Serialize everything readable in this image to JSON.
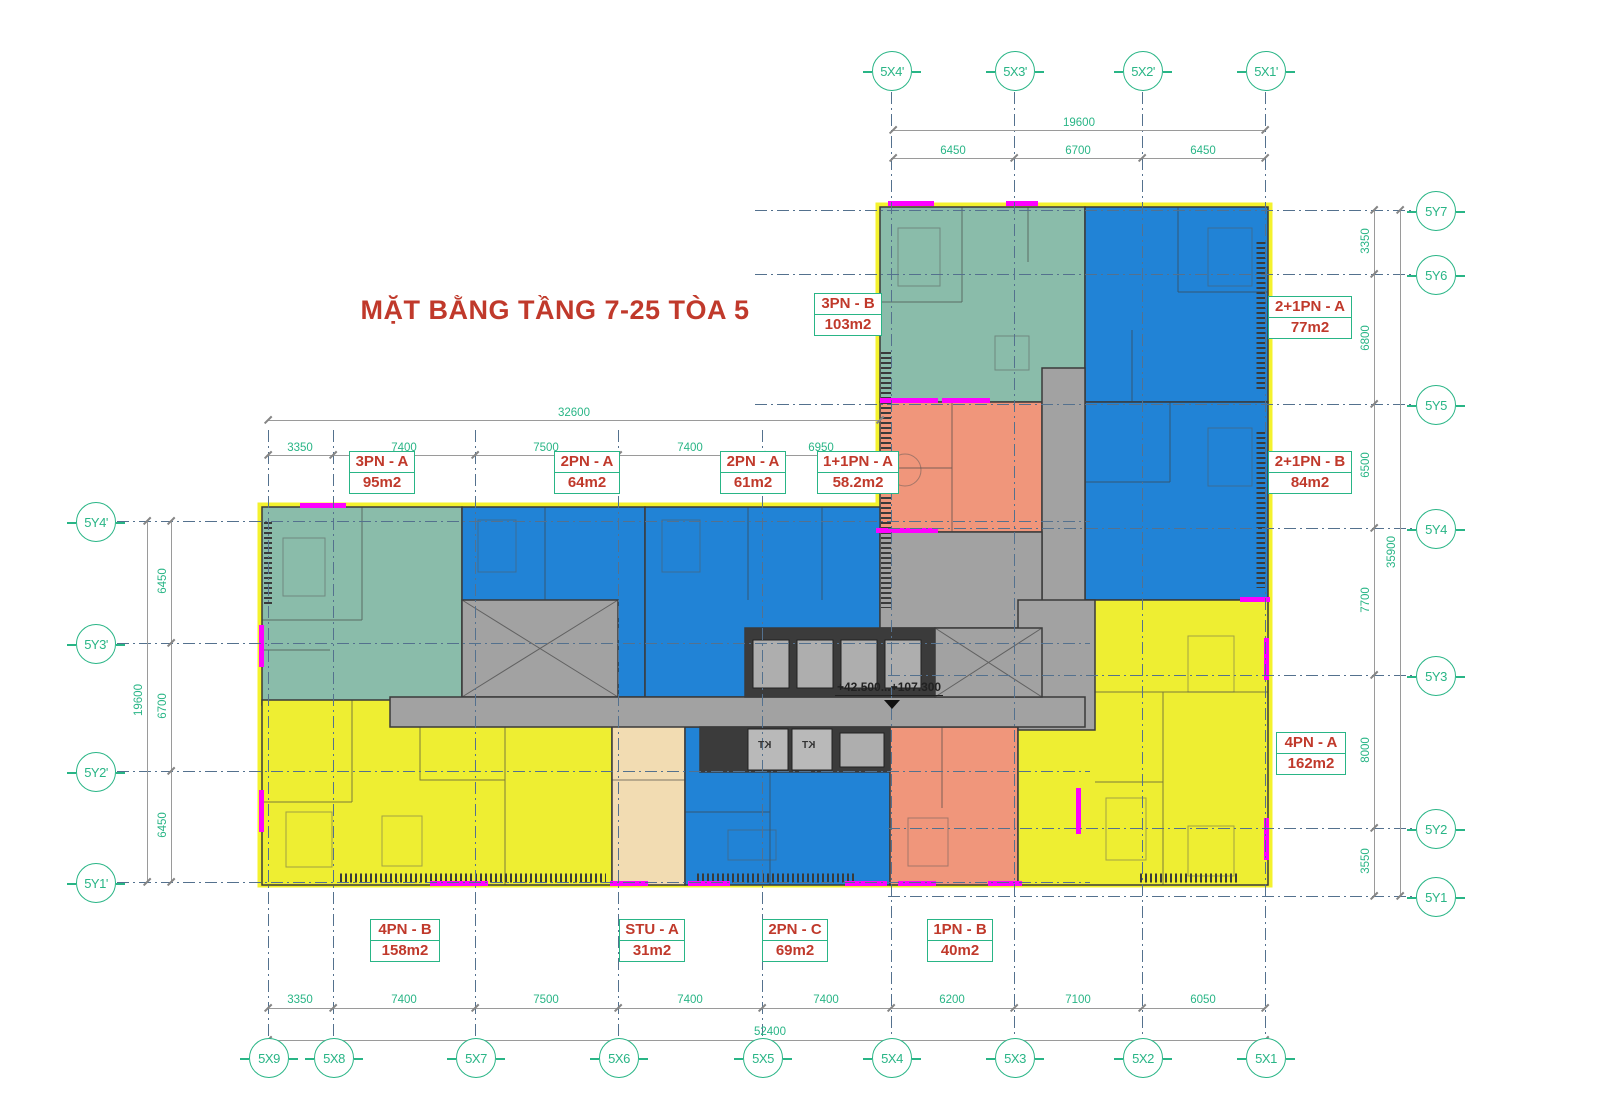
{
  "title": "MẶT BẰNG TẦNG 7-25 TÒA 5",
  "level_note": "+42.500...+107.300",
  "shaft_label": "KT",
  "colors": {
    "green": "#29b586",
    "red": "#c0392b",
    "teal": "#8abcaa",
    "blue": "#2183d6",
    "yellow": "#eeee32",
    "salmon": "#f0967b",
    "cream": "#f2dcb2",
    "gray": "#a2a2a2",
    "dark": "#3b3b3b",
    "magenta": "#ff00ff",
    "dimline": "#9a9a9a",
    "grid": "#54718e",
    "oyellow": "#f4f22e"
  },
  "axes": {
    "top": {
      "cy": 70,
      "circles": [
        {
          "label": "5X4'",
          "x": 891
        },
        {
          "label": "5X3'",
          "x": 1014
        },
        {
          "label": "5X2'",
          "x": 1142
        },
        {
          "label": "5X1'",
          "x": 1265
        }
      ]
    },
    "bottom": {
      "cy": 1057,
      "circles": [
        {
          "label": "5X9",
          "x": 268
        },
        {
          "label": "5X8",
          "x": 333
        },
        {
          "label": "5X7",
          "x": 475
        },
        {
          "label": "5X6",
          "x": 618
        },
        {
          "label": "5X5",
          "x": 762
        },
        {
          "label": "5X4",
          "x": 891
        },
        {
          "label": "5X3",
          "x": 1014
        },
        {
          "label": "5X2",
          "x": 1142
        },
        {
          "label": "5X1",
          "x": 1265
        }
      ]
    },
    "left": {
      "cx": 95,
      "circles": [
        {
          "label": "5Y4'",
          "y": 521
        },
        {
          "label": "5Y3'",
          "y": 643
        },
        {
          "label": "5Y2'",
          "y": 771
        },
        {
          "label": "5Y1'",
          "y": 882
        }
      ]
    },
    "right": {
      "cx": 1435,
      "circles": [
        {
          "label": "5Y7",
          "y": 210
        },
        {
          "label": "5Y6",
          "y": 274
        },
        {
          "label": "5Y5",
          "y": 404
        },
        {
          "label": "5Y4",
          "y": 528
        },
        {
          "label": "5Y3",
          "y": 675
        },
        {
          "label": "5Y2",
          "y": 828
        },
        {
          "label": "5Y1",
          "y": 896
        }
      ]
    }
  },
  "grid_lines": [
    {
      "dir": "v",
      "x": 891,
      "y1": 92,
      "y2": 1036
    },
    {
      "dir": "v",
      "x": 1014,
      "y1": 92,
      "y2": 1036
    },
    {
      "dir": "v",
      "x": 1142,
      "y1": 92,
      "y2": 1036
    },
    {
      "dir": "v",
      "x": 1265,
      "y1": 92,
      "y2": 1036
    },
    {
      "dir": "v",
      "x": 268,
      "y1": 430,
      "y2": 1036
    },
    {
      "dir": "v",
      "x": 333,
      "y1": 430,
      "y2": 1036
    },
    {
      "dir": "v",
      "x": 475,
      "y1": 430,
      "y2": 1036
    },
    {
      "dir": "v",
      "x": 618,
      "y1": 430,
      "y2": 1036
    },
    {
      "dir": "v",
      "x": 762,
      "y1": 430,
      "y2": 1036
    },
    {
      "dir": "h",
      "y": 521,
      "x1": 117,
      "x2": 1090
    },
    {
      "dir": "h",
      "y": 643,
      "x1": 117,
      "x2": 1090
    },
    {
      "dir": "h",
      "y": 771,
      "x1": 117,
      "x2": 1090
    },
    {
      "dir": "h",
      "y": 882,
      "x1": 117,
      "x2": 1090
    },
    {
      "dir": "h",
      "y": 210,
      "x1": 755,
      "x2": 1414
    },
    {
      "dir": "h",
      "y": 274,
      "x1": 755,
      "x2": 1414
    },
    {
      "dir": "h",
      "y": 404,
      "x1": 755,
      "x2": 1414
    },
    {
      "dir": "h",
      "y": 528,
      "x1": 888,
      "x2": 1414
    },
    {
      "dir": "h",
      "y": 675,
      "x1": 888,
      "x2": 1414
    },
    {
      "dir": "h",
      "y": 828,
      "x1": 888,
      "x2": 1414
    },
    {
      "dir": "h",
      "y": 896,
      "x1": 888,
      "x2": 1414
    }
  ],
  "dimensions": [
    {
      "dir": "h",
      "y": 130,
      "x1": 893,
      "x2": 1265,
      "vy": 117,
      "ticks": [
        893,
        1265
      ],
      "values": [
        {
          "t": "19600",
          "x": 1079
        }
      ]
    },
    {
      "dir": "h",
      "y": 158,
      "x1": 893,
      "x2": 1265,
      "vy": 145,
      "ticks": [
        893,
        1014,
        1142,
        1265
      ],
      "values": [
        {
          "t": "6450",
          "x": 953
        },
        {
          "t": "6700",
          "x": 1078
        },
        {
          "t": "6450",
          "x": 1203
        }
      ]
    },
    {
      "dir": "h",
      "y": 420,
      "x1": 268,
      "x2": 880,
      "vy": 407,
      "ticks": [
        268,
        880
      ],
      "values": [
        {
          "t": "32600",
          "x": 574
        }
      ]
    },
    {
      "dir": "h",
      "y": 455,
      "x1": 268,
      "x2": 880,
      "vy": 442,
      "ticks": [
        268,
        333,
        475,
        618,
        762,
        880
      ],
      "values": [
        {
          "t": "3350",
          "x": 300
        },
        {
          "t": "7400",
          "x": 404
        },
        {
          "t": "7500",
          "x": 546
        },
        {
          "t": "7400",
          "x": 690
        },
        {
          "t": "6950",
          "x": 821
        }
      ]
    },
    {
      "dir": "h",
      "y": 1008,
      "x1": 268,
      "x2": 1265,
      "vy": 994,
      "ticks": [
        268,
        333,
        475,
        618,
        762,
        891,
        1014,
        1142,
        1265
      ],
      "values": [
        {
          "t": "3350",
          "x": 300
        },
        {
          "t": "7400",
          "x": 404
        },
        {
          "t": "7500",
          "x": 546
        },
        {
          "t": "7400",
          "x": 690
        },
        {
          "t": "7400",
          "x": 826
        },
        {
          "t": "6200",
          "x": 952
        },
        {
          "t": "7100",
          "x": 1078
        },
        {
          "t": "6050",
          "x": 1203
        }
      ]
    },
    {
      "dir": "h",
      "y": 1040,
      "x1": 268,
      "x2": 1265,
      "vy": 1026,
      "ticks": [
        268,
        1265
      ],
      "values": [
        {
          "t": "52400",
          "x": 770
        }
      ]
    },
    {
      "dir": "v",
      "x": 1374,
      "y1": 210,
      "y2": 896,
      "vx": 1366,
      "ticks": [
        210,
        274,
        404,
        528,
        675,
        828,
        896
      ],
      "values": [
        {
          "t": "3350",
          "y": 242
        },
        {
          "t": "6800",
          "y": 339
        },
        {
          "t": "6500",
          "y": 466
        },
        {
          "t": "7700",
          "y": 601
        },
        {
          "t": "8000",
          "y": 751
        },
        {
          "t": "3550",
          "y": 862
        }
      ]
    },
    {
      "dir": "v",
      "x": 1400,
      "y1": 210,
      "y2": 896,
      "vx": 1392,
      "ticks": [
        210,
        896
      ],
      "values": [
        {
          "t": "35900",
          "y": 553
        }
      ]
    },
    {
      "dir": "v",
      "x": 147,
      "y1": 521,
      "y2": 882,
      "vx": 139,
      "ticks": [
        521,
        882
      ],
      "values": [
        {
          "t": "19600",
          "y": 701
        }
      ]
    },
    {
      "dir": "v",
      "x": 171,
      "y1": 521,
      "y2": 882,
      "vx": 163,
      "ticks": [
        521,
        643,
        771,
        882
      ],
      "values": [
        {
          "t": "6450",
          "y": 582
        },
        {
          "t": "6700",
          "y": 707
        },
        {
          "t": "6450",
          "y": 826
        }
      ]
    }
  ],
  "apartment_labels": [
    {
      "type": "3PN - B",
      "area": "103m2",
      "cx": 848,
      "top": 293,
      "w": 68
    },
    {
      "type": "2+1PN - A",
      "area": "77m2",
      "cx": 1310,
      "top": 296,
      "w": 84
    },
    {
      "type": "2+1PN - B",
      "area": "84m2",
      "cx": 1310,
      "top": 451,
      "w": 84
    },
    {
      "type": "4PN - A",
      "area": "162m2",
      "cx": 1311,
      "top": 732,
      "w": 70
    },
    {
      "type": "3PN - A",
      "area": "95m2",
      "cx": 382,
      "top": 451,
      "w": 66
    },
    {
      "type": "2PN - A",
      "area": "64m2",
      "cx": 587,
      "top": 451,
      "w": 66
    },
    {
      "type": "2PN - A",
      "area": "61m2",
      "cx": 753,
      "top": 451,
      "w": 66
    },
    {
      "type": "1+1PN - A",
      "area": "58.2m2",
      "cx": 858,
      "top": 451,
      "w": 82
    },
    {
      "type": "4PN - B",
      "area": "158m2",
      "cx": 405,
      "top": 919,
      "w": 70
    },
    {
      "type": "STU - A",
      "area": "31m2",
      "cx": 652,
      "top": 919,
      "w": 66
    },
    {
      "type": "2PN - C",
      "area": "69m2",
      "cx": 795,
      "top": 919,
      "w": 66
    },
    {
      "type": "1PN - B",
      "area": "40m2",
      "cx": 960,
      "top": 919,
      "w": 66
    }
  ],
  "shafts": [
    {
      "x": 758,
      "y": 740
    },
    {
      "x": 802,
      "y": 740
    }
  ]
}
